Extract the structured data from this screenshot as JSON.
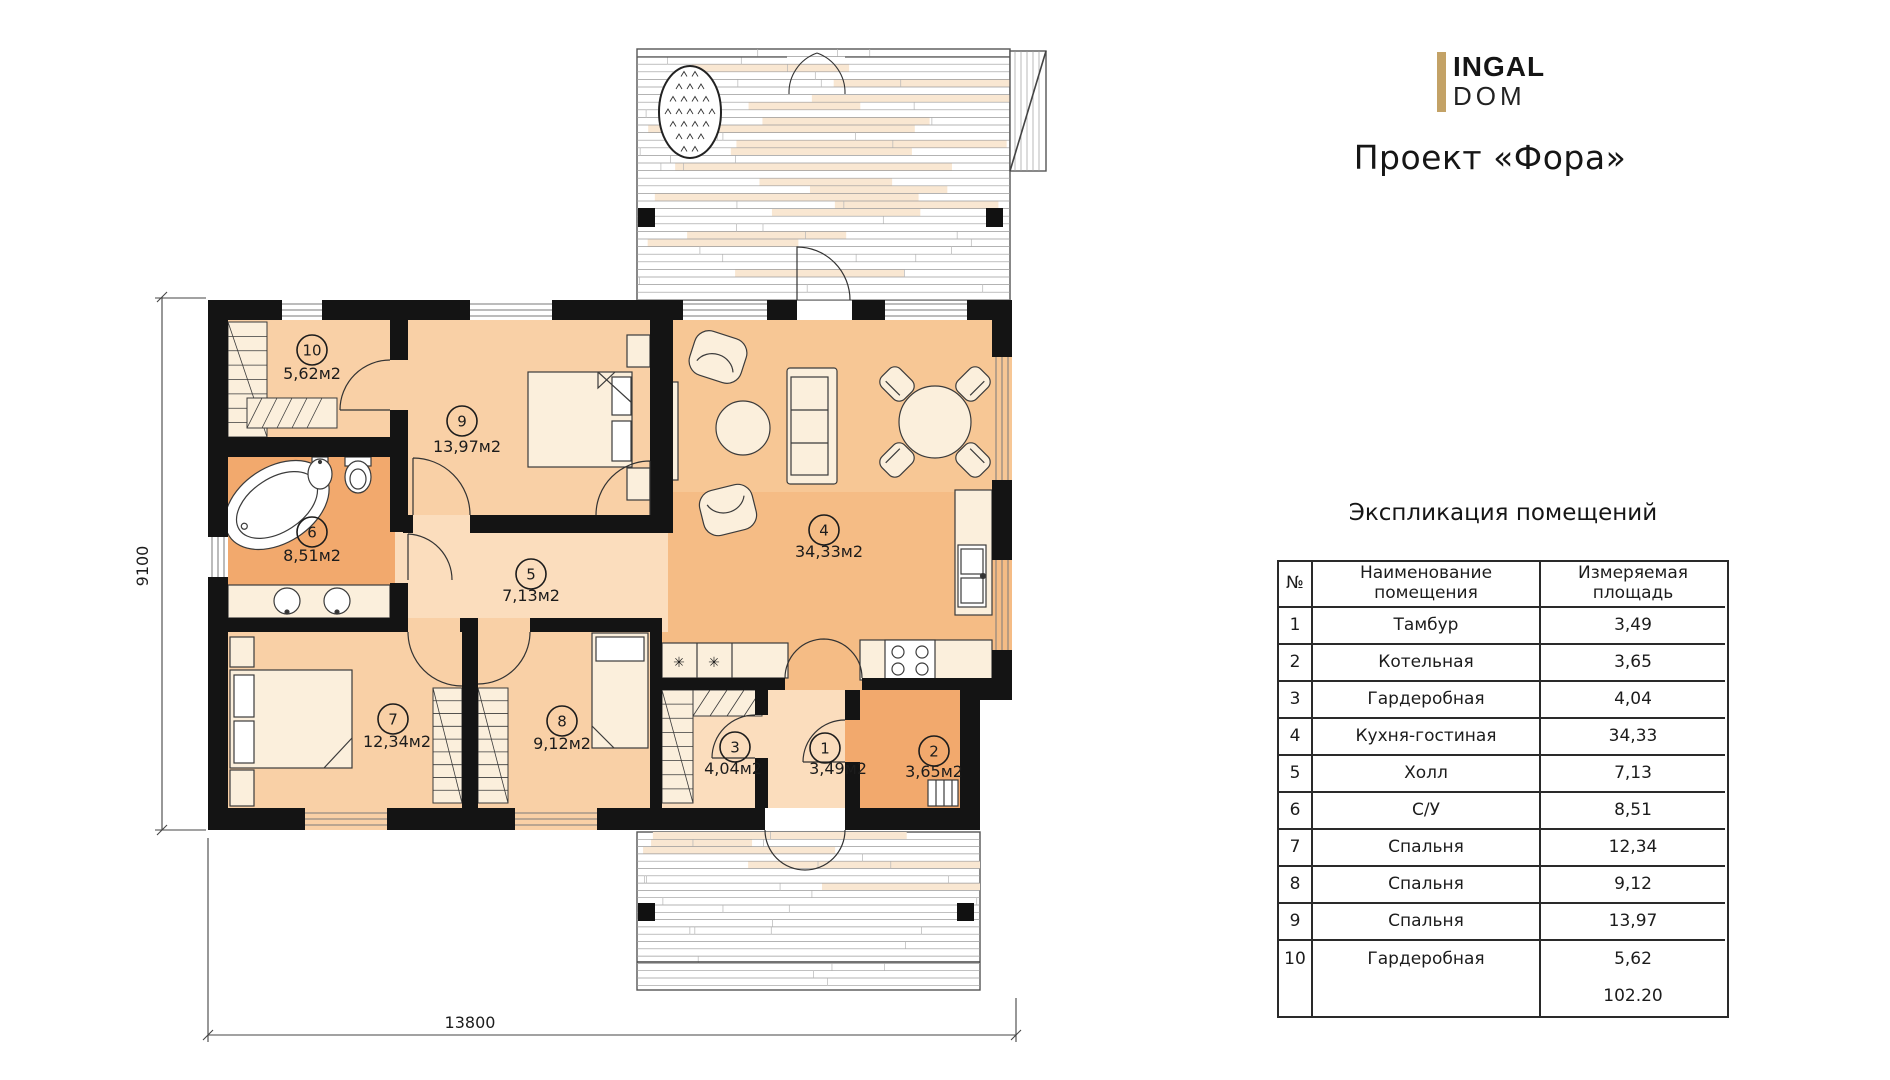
{
  "brand": {
    "line1": "INGAL",
    "line2": "DOM",
    "accent": "#C3A266"
  },
  "header": {
    "project_title": "Проект «Фора»"
  },
  "plan": {
    "dim_bottom": "13800",
    "dim_left": "9100",
    "rooms": [
      {
        "num": "1",
        "area": "3,49м2",
        "cx": 825,
        "cy": 748,
        "tx": 838,
        "ty": 774
      },
      {
        "num": "2",
        "area": "3,65м2",
        "cx": 934,
        "cy": 751,
        "tx": 934,
        "ty": 777
      },
      {
        "num": "3",
        "area": "4,04м2",
        "cx": 735,
        "cy": 747,
        "tx": 733,
        "ty": 774
      },
      {
        "num": "4",
        "area": "34,33м2",
        "cx": 824,
        "cy": 530,
        "tx": 829,
        "ty": 557
      },
      {
        "num": "5",
        "area": "7,13м2",
        "cx": 531,
        "cy": 574,
        "tx": 531,
        "ty": 601
      },
      {
        "num": "6",
        "area": "8,51м2",
        "cx": 312,
        "cy": 532,
        "tx": 312,
        "ty": 561
      },
      {
        "num": "7",
        "area": "12,34м2",
        "cx": 393,
        "cy": 719,
        "tx": 397,
        "ty": 747
      },
      {
        "num": "8",
        "area": "9,12м2",
        "cx": 562,
        "cy": 721,
        "tx": 562,
        "ty": 749
      },
      {
        "num": "9",
        "area": "13,97м2",
        "cx": 462,
        "cy": 421,
        "tx": 467,
        "ty": 452
      },
      {
        "num": "10",
        "area": "5,62м2",
        "cx": 312,
        "cy": 350,
        "tx": 312,
        "ty": 379
      }
    ]
  },
  "legend_table": {
    "title": "Экспликация помещений",
    "headers": {
      "num": "№",
      "name": "Наименование помещения",
      "area": "Измеряемая площадь"
    },
    "rows": [
      {
        "num": "1",
        "name": "Тамбур",
        "area": "3,49"
      },
      {
        "num": "2",
        "name": "Котельная",
        "area": "3,65"
      },
      {
        "num": "3",
        "name": "Гардеробная",
        "area": "4,04"
      },
      {
        "num": "4",
        "name": "Кухня-гостиная",
        "area": "34,33"
      },
      {
        "num": "5",
        "name": "Холл",
        "area": "7,13"
      },
      {
        "num": "6",
        "name": "С/У",
        "area": "8,51"
      },
      {
        "num": "7",
        "name": "Спальня",
        "area": "12,34"
      },
      {
        "num": "8",
        "name": "Спальня",
        "area": "9,12"
      },
      {
        "num": "9",
        "name": "Спальня",
        "area": "13,97"
      },
      {
        "num": "10",
        "name": "Гардеробная",
        "area": "5,62"
      }
    ],
    "total": "102.20"
  }
}
